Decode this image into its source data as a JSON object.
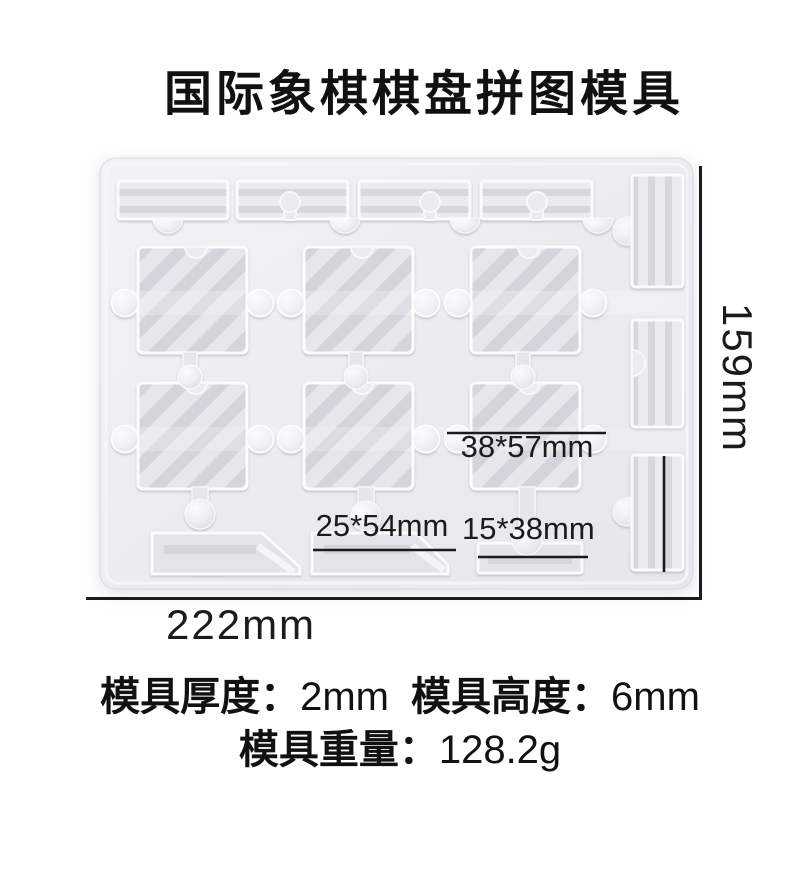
{
  "header": {
    "title": "国际象棋棋盘拼图模具"
  },
  "figure": {
    "description": "Top view photo of a white translucent silicone mold with chess-board puzzle piece cavities",
    "annotations": {
      "piece_large": "38*57mm",
      "piece_medium": "25*54mm",
      "piece_small": "15*38mm"
    },
    "dimensions": {
      "width": "222mm",
      "height": "159mm"
    },
    "colors": {
      "background": "#ffffff",
      "mold_body": "#e9ecf0",
      "cavity": "#e2e5e9",
      "stripe": "#d2d6dc",
      "rim_highlight": "#fafbfd",
      "annotation": "#1b1b1b"
    }
  },
  "specs": {
    "thickness_label": "模具厚度：",
    "thickness_value": "2mm",
    "height_label": "模具高度：",
    "height_value": "6mm",
    "weight_label": "模具重量：",
    "weight_value": "128.2g"
  }
}
